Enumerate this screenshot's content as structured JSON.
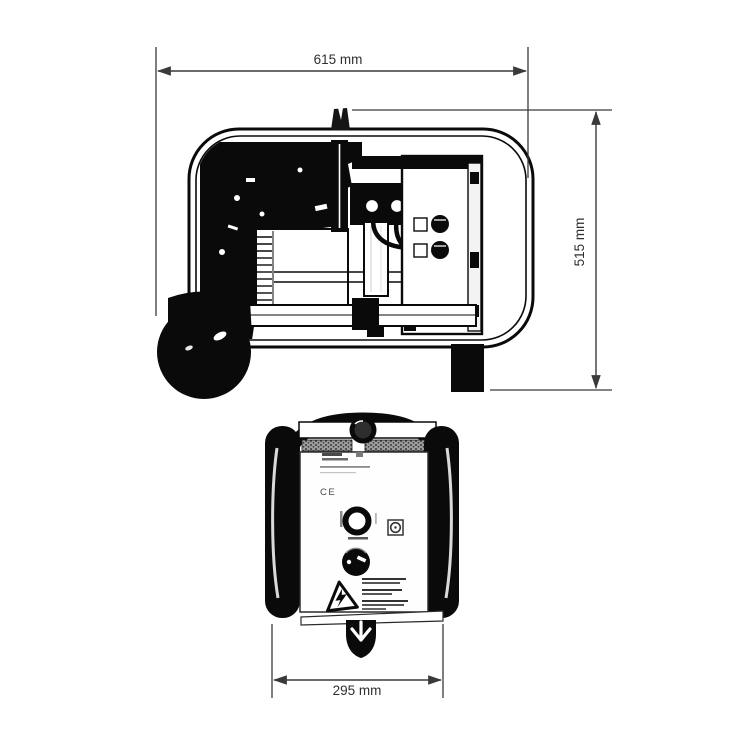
{
  "dimensions": {
    "top_width": "615 mm",
    "right_height": "515 mm",
    "bottom_width": "295 mm"
  },
  "front_panel": {
    "ce_mark": "CE"
  },
  "colors": {
    "ink": "#0a0a0a",
    "dimension_line": "#3a3a3a",
    "dimension_text": "#2f2f2f",
    "background": "#ffffff"
  }
}
